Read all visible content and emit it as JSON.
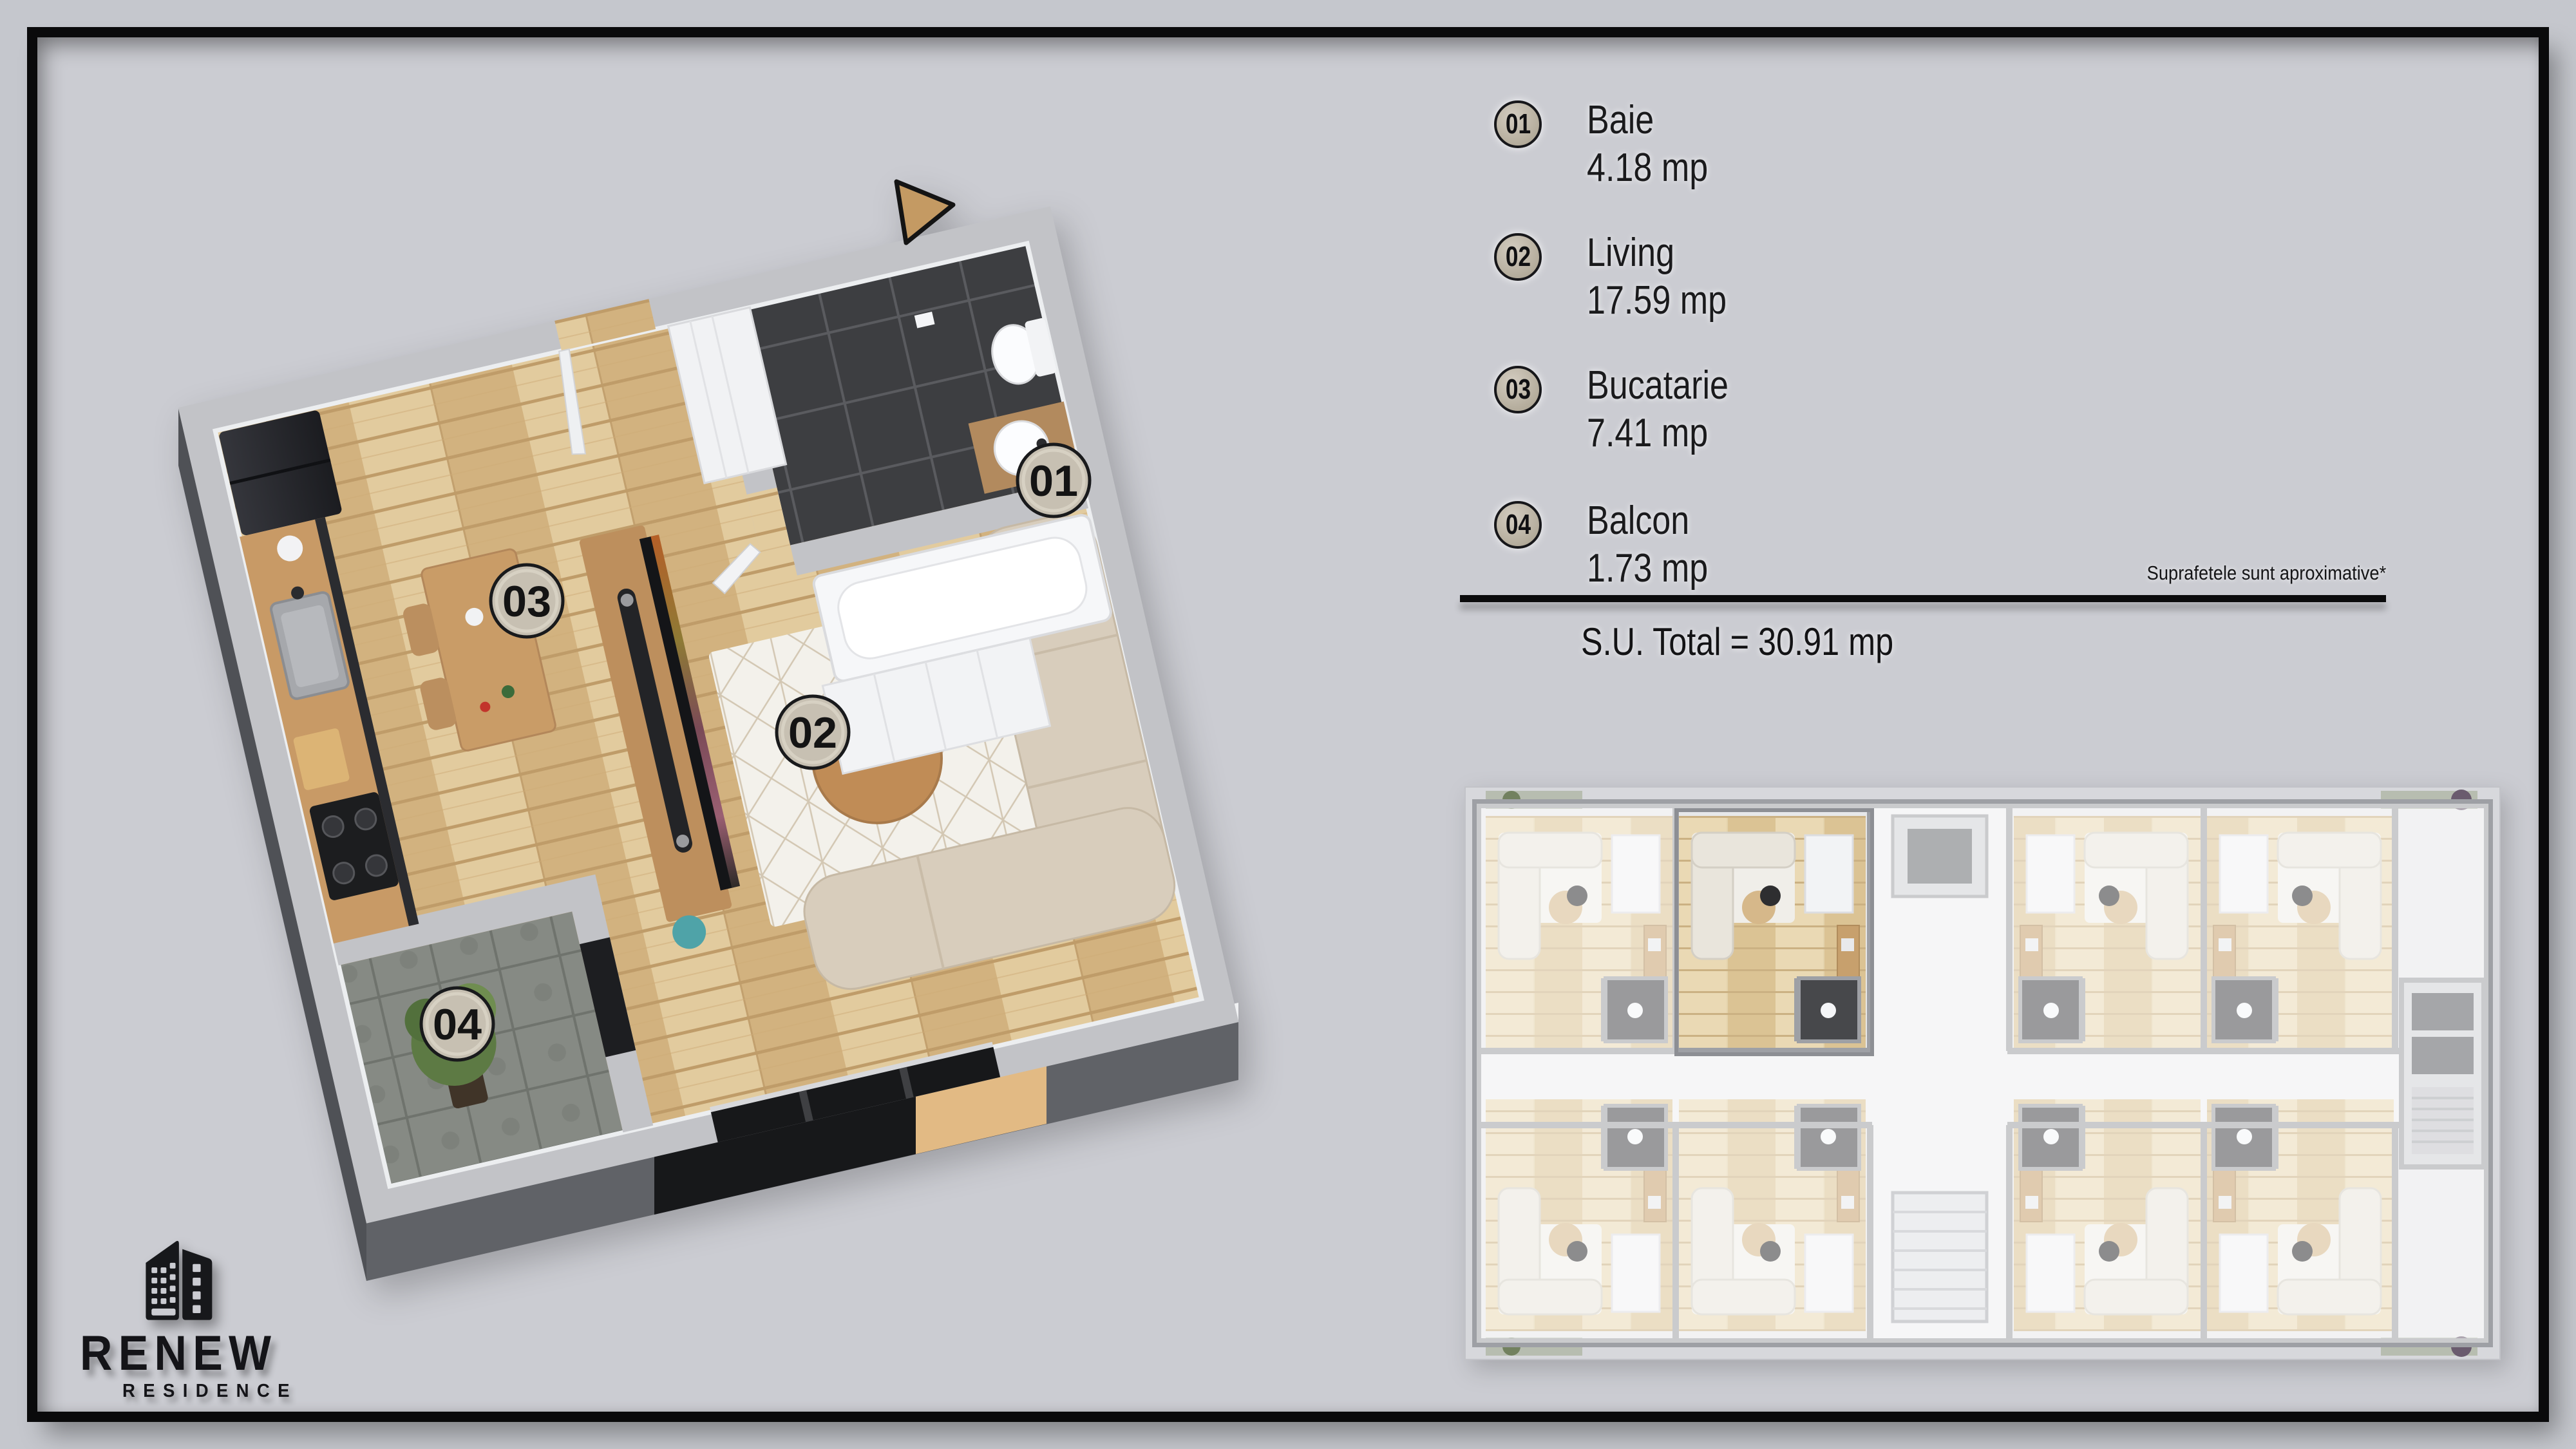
{
  "poster": {
    "background_outer": "#c5c7cd",
    "background_inner": "#cbccd2",
    "frame_color": "#0a0a0b",
    "accent_tan": "#c49a63"
  },
  "plan3d": {
    "badges": [
      "01",
      "02",
      "03",
      "04"
    ]
  },
  "legend": {
    "items": [
      {
        "num": "01",
        "label": "Baie",
        "area": "4.18 mp"
      },
      {
        "num": "02",
        "label": "Living",
        "area": "17.59 mp"
      },
      {
        "num": "03",
        "label": "Bucatarie",
        "area": "7.41 mp"
      },
      {
        "num": "04",
        "label": "Balcon",
        "area": "1.73 mp"
      }
    ],
    "note": "Suprafetele sunt aproximative*",
    "total": "S.U. Total = 30.91 mp"
  },
  "logo": {
    "title": "RENEW",
    "subtitle": "RESIDENCE"
  }
}
